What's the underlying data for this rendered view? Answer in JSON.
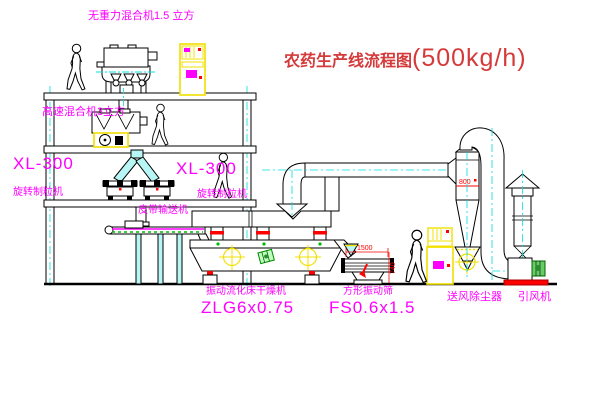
{
  "title": {
    "zh": "农药生产线流程图",
    "capacity": "(500kg/h)"
  },
  "labels": {
    "gravity_mixer": "无重力混合机1.5 立方",
    "high_speed_mixer": "高速混合机3立方",
    "granulator_left_model": "XL-300",
    "granulator_left_name": "旋转制粒机",
    "granulator_mid_model": "XL-300",
    "granulator_mid_name": "旋转制粒机",
    "belt_conveyor": "皮带输送机",
    "dryer_name": "振动流化床干燥机",
    "dryer_model": "ZLG6x0.75",
    "screen_name": "方形振动筛",
    "screen_model": "FS0.6x1.5",
    "dust_collector": "送风除尘器",
    "induced_fan": "引风机"
  },
  "dimensions": {
    "screen_width": "1500",
    "screen_height": "740",
    "cyclone_dia": "800"
  },
  "colors": {
    "line": "#000000",
    "centerline": "#00e0e0",
    "label_magenta": "#ff00ff",
    "title_red": "#d43a3a",
    "dimension_red": "#ff0000",
    "cabinet_yellow": "#f0e000",
    "target_yellow": "#f0e000",
    "motor_green": "#2e8b2e",
    "chute_cyan": "#b8f6f6"
  }
}
